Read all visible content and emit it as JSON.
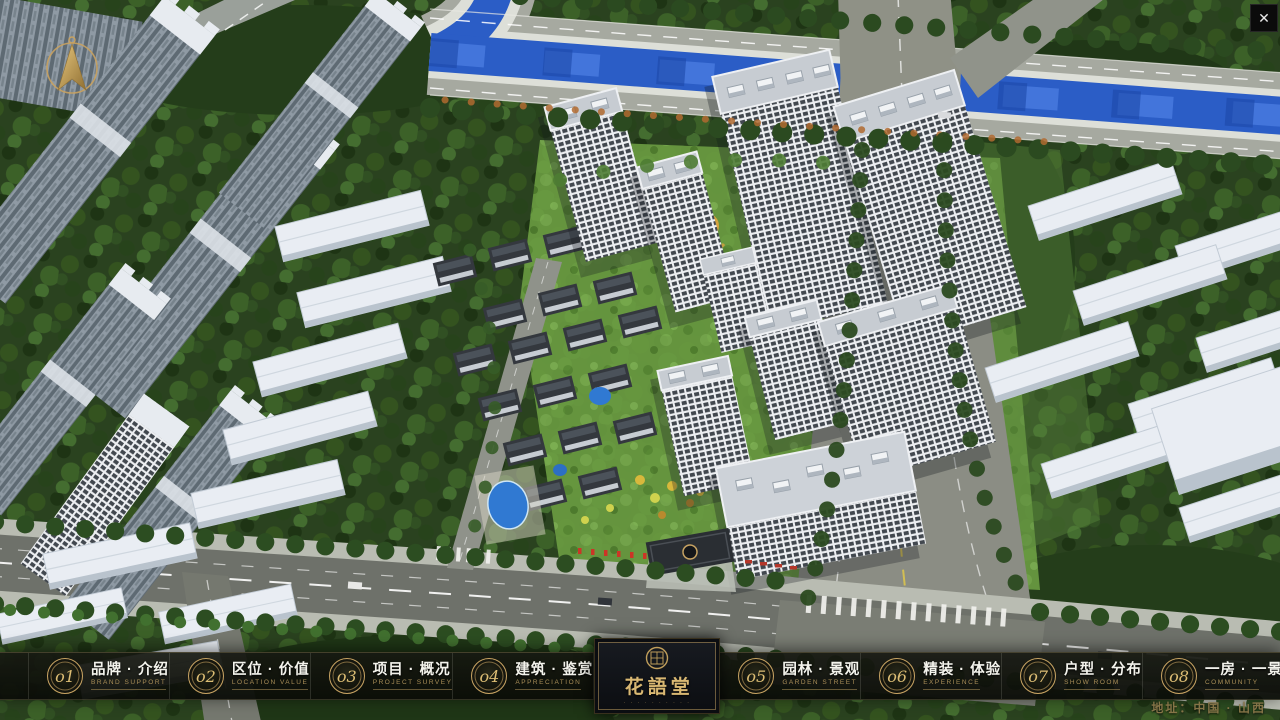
{
  "window": {
    "close_icon": "✕"
  },
  "nav": {
    "items": [
      {
        "num": "o1",
        "zh": "品牌 · 介绍",
        "en": "BRAND SUPPORT"
      },
      {
        "num": "o2",
        "zh": "区位 · 价值",
        "en": "LOCATION VALUE"
      },
      {
        "num": "o3",
        "zh": "项目 · 概况",
        "en": "PROJECT SURVEY"
      },
      {
        "num": "o4",
        "zh": "建筑 · 鉴赏",
        "en": "APPRECIATION"
      },
      {
        "num": "o5",
        "zh": "园林 · 景观",
        "en": "GARDEN STREET"
      },
      {
        "num": "o6",
        "zh": "精装 · 体验",
        "en": "EXPERIENCE"
      },
      {
        "num": "o7",
        "zh": "户型 · 分布",
        "en": "SHOW ROOM"
      },
      {
        "num": "o8",
        "zh": "一房 · 一景",
        "en": "COMMUNITY"
      }
    ],
    "logo": {
      "title": "花語堂",
      "tagline": "· · · · · · · · · ·"
    }
  },
  "footer": {
    "address": "地址：中国 · 山西"
  },
  "colors": {
    "accent_gold": "#c8a463",
    "river_blue": "#2b5dc6",
    "navbar_bg": "#12140e",
    "building_white": "#e9edf3"
  }
}
